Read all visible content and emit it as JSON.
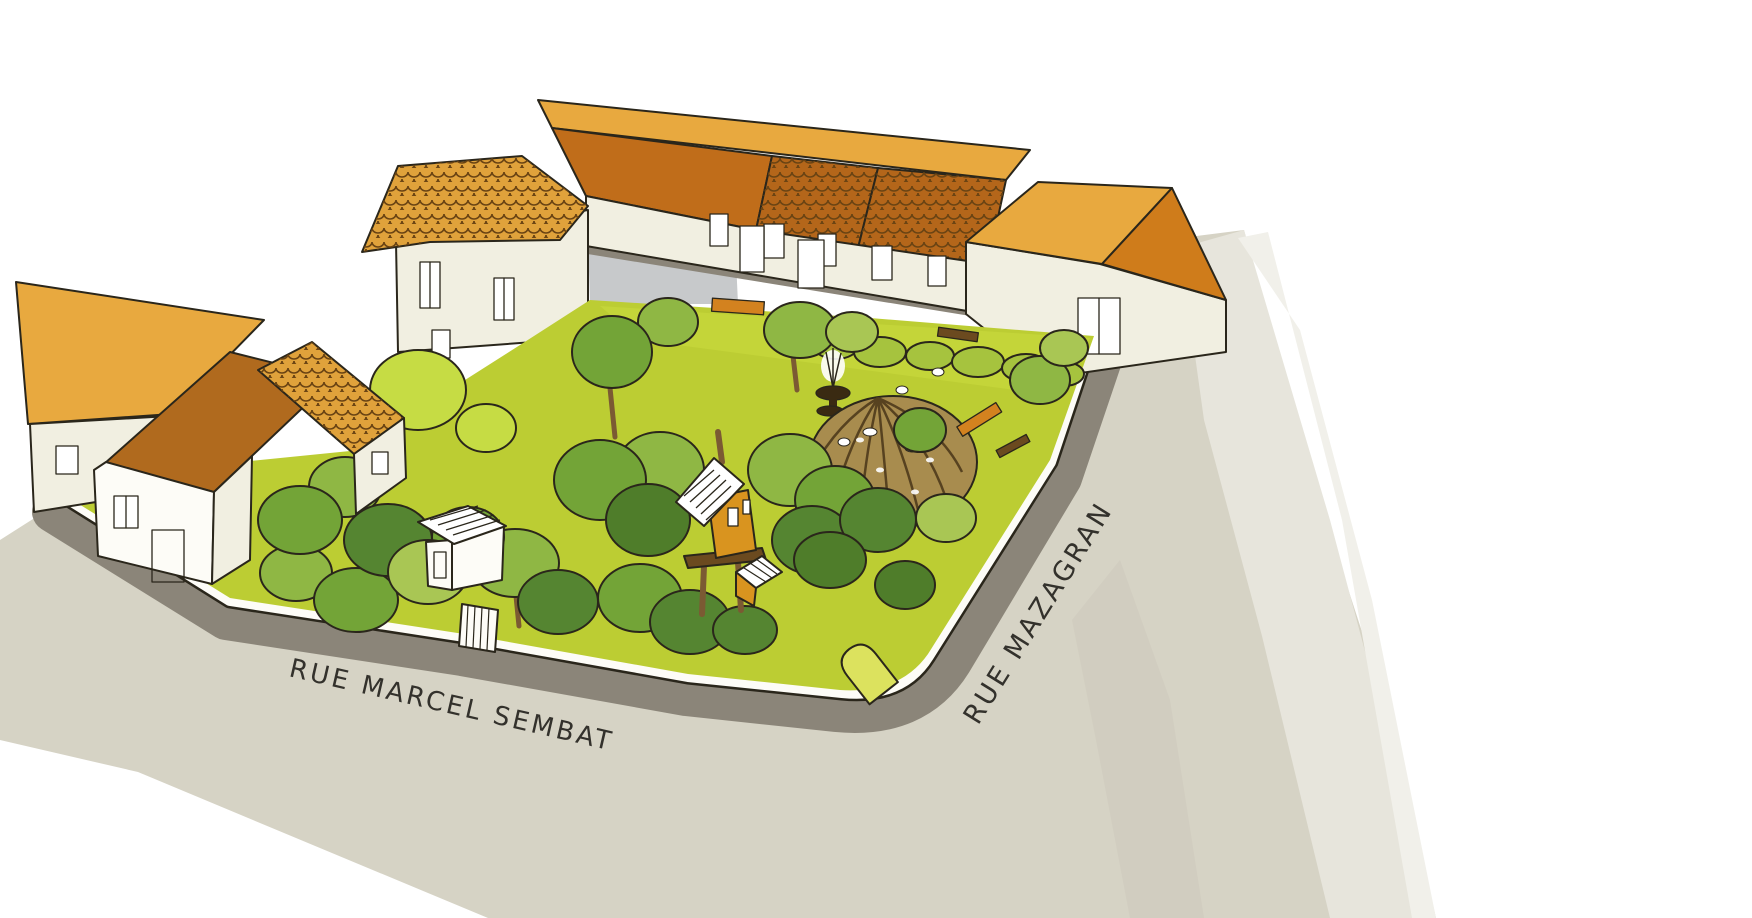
{
  "streets": {
    "marcel_sembat": {
      "label": "RUE MARCEL SEMBAT"
    },
    "mazagran": {
      "label": "RUE MAZAGRAN"
    }
  },
  "colors": {
    "background": "#ffffff",
    "street": "#d6d3c5",
    "street_shadow": "#9d988b",
    "street_streak": "#cdc9bb",
    "sidewalk_band": "#8b8579",
    "courtyard": "#c7c9cb",
    "courtyard_band": "#7d7a70",
    "wall_white": "#fdfcf7",
    "wall_cream": "#f1efe1",
    "roof_light": "#e8a93f",
    "roof_dark_flat": "#c06d1a",
    "roof_terracotta": "#b4661a",
    "roof_tile_base": "#e0a23b",
    "roof_brown": "#b06a1e",
    "roof_dark2": "#cf7c1b",
    "lawn": "#bccd33",
    "lawn_light": "#c8d83c",
    "hedge": "#a6c33e",
    "tree_light": "#c6dc44",
    "tree_yellow": "#a9c654",
    "tree_mid": "#8fb744",
    "tree_green": "#73a437",
    "tree_dark": "#558531",
    "tree_deep": "#4f7d2a",
    "trunk": "#7b5a33",
    "dome": "#a88c4e",
    "dome_rib": "#574220",
    "fountain": "#3a2a12",
    "bench_orange": "#d3821f",
    "bench_brown": "#6b4a1f",
    "treehouse": "#d9941f",
    "arch_gate": "#dce25e",
    "watercolor_1": "#e7e5dc",
    "watercolor_2": "#f1f0ea",
    "label": "#33312c"
  }
}
